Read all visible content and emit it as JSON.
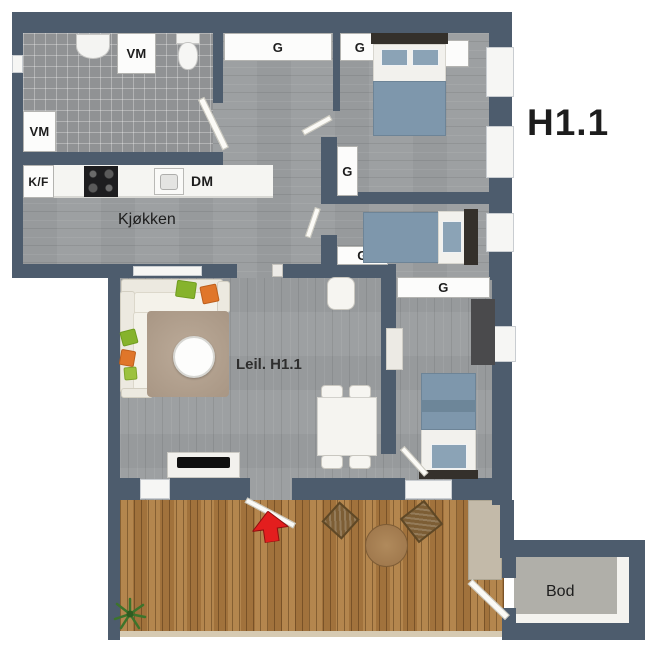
{
  "title": "H1.1",
  "unit_label": "Leil. H1.1",
  "labels": {
    "kitchen": "Kjøkken",
    "storage": "Bod",
    "wardrobe": "G",
    "washing_machine": "VM",
    "fridge_freezer": "K/F",
    "dishwasher": "DM"
  },
  "colors": {
    "wall": "#4d5c6d",
    "interior_wood_floor": "#9da0a2",
    "bathroom_tile": "#909294",
    "deck_wood": "#aa7a42",
    "bed_blue": "#7e97ac",
    "pillow_blue": "#8ba3b6",
    "sofa_cream": "#ece9e0",
    "rug_beige": "#b3a290",
    "entrance_arrow_red": "#e31e1e",
    "text": "#1d1d1d"
  }
}
